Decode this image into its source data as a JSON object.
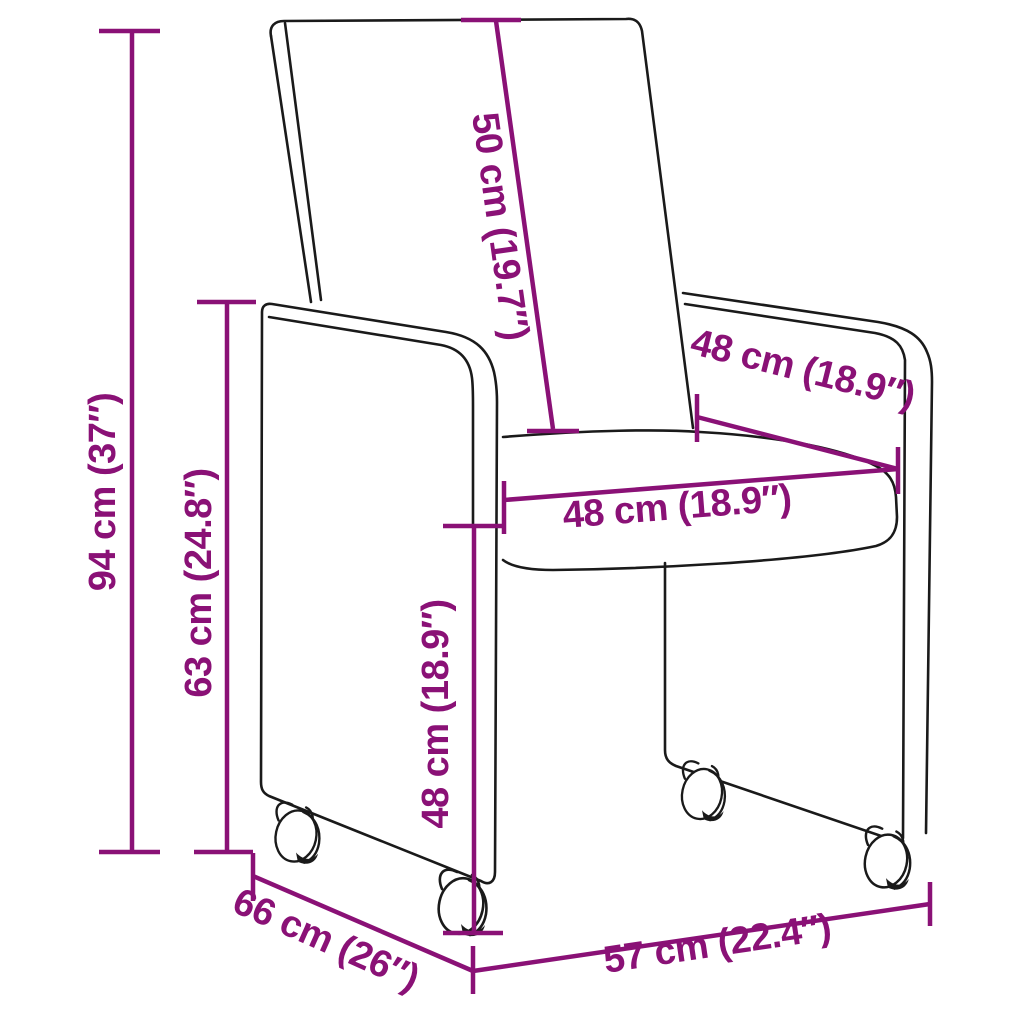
{
  "colors": {
    "accent": "#8a1176",
    "outline": "#1a1a1a",
    "background": "#ffffff"
  },
  "measurements": {
    "overall_height": "94 cm (37″)",
    "armrest_height": "63 cm (24.8″)",
    "backrest_length": "50 cm (19.7″)",
    "seat_width": "48 cm (18.9″)",
    "seat_depth": "48 cm (18.9″)",
    "seat_height": "48 cm (18.9″)",
    "overall_depth": "66 cm (26″)",
    "overall_width": "57 cm (22.4″)"
  }
}
